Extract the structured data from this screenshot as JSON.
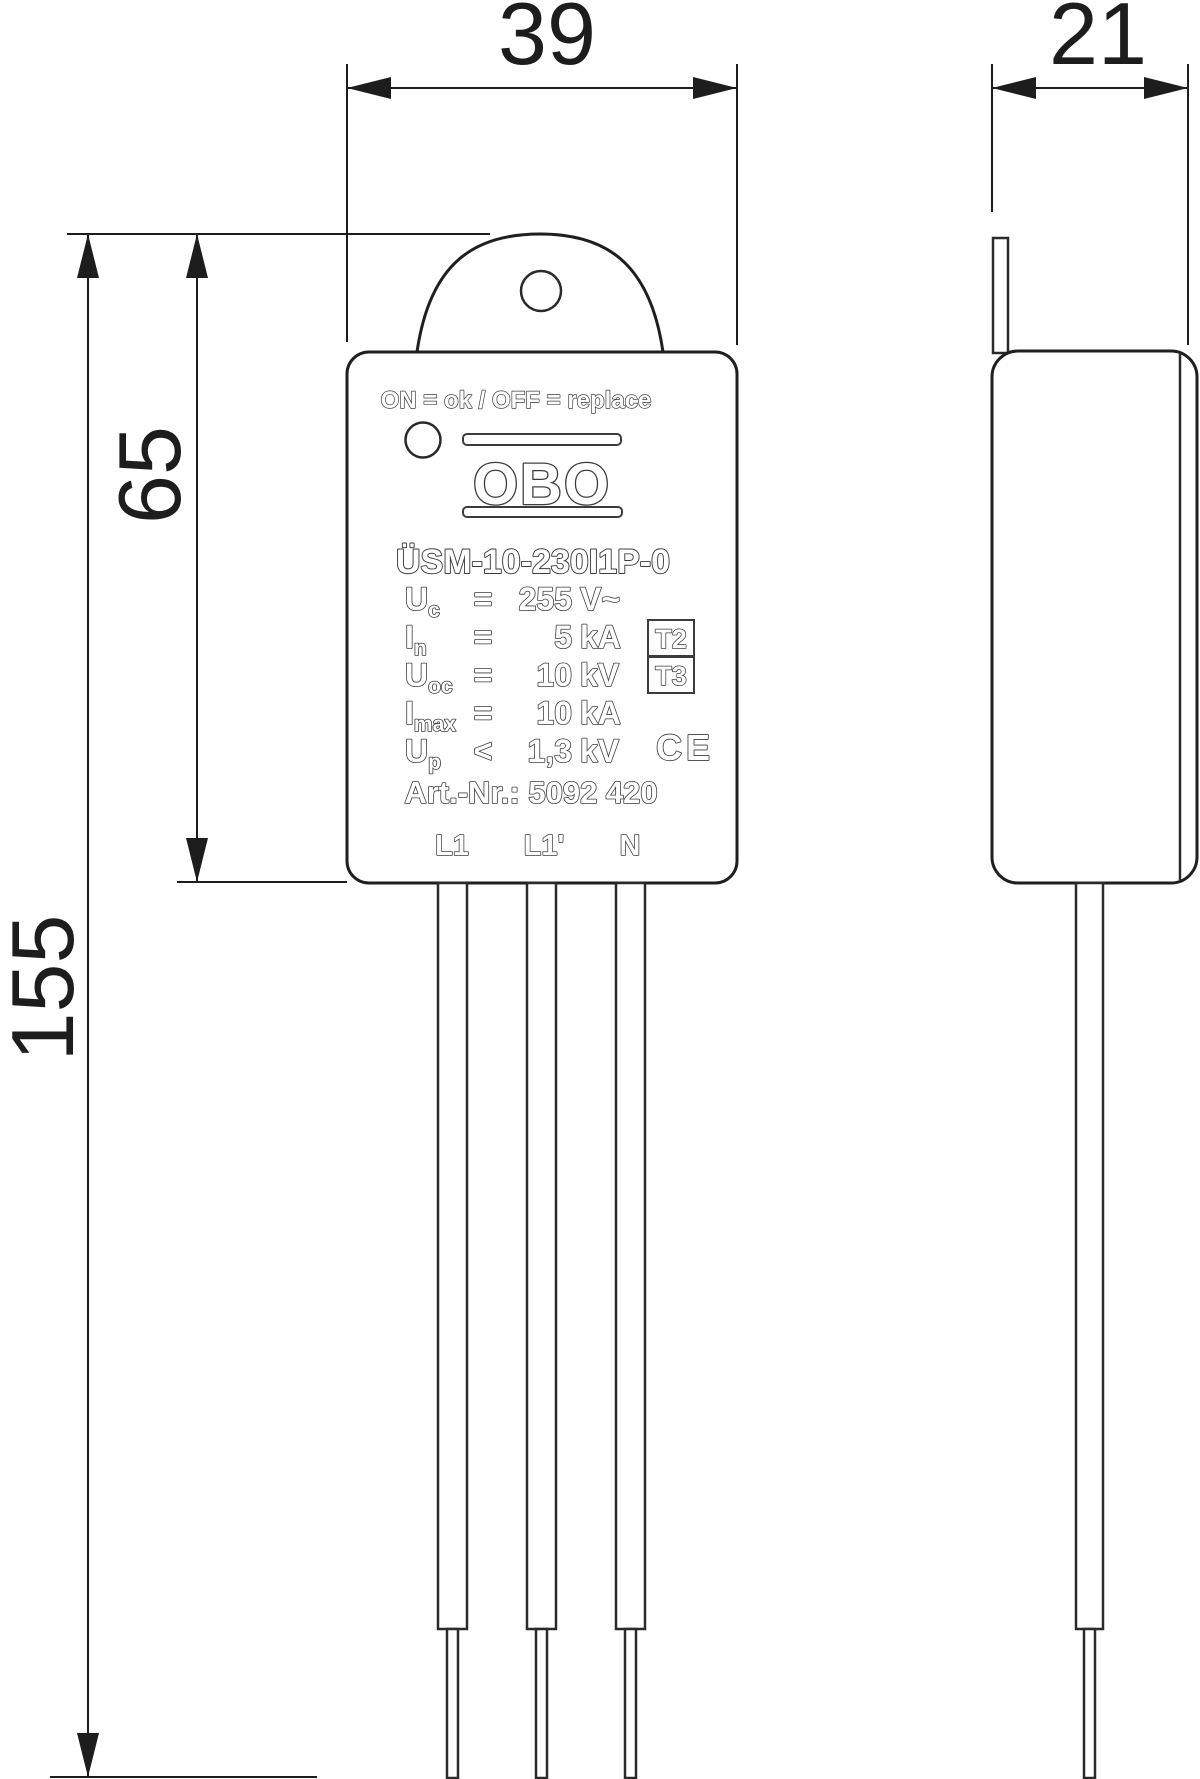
{
  "dimensions": {
    "front_width": "39",
    "side_depth": "21",
    "body_height": "65",
    "total_height": "155"
  },
  "device_label": {
    "status_line": "ON = ok  /  OFF = replace",
    "brand": "OBO",
    "model": "ÜSM-10-230I1P-0",
    "specs": [
      {
        "symbol": "U",
        "subscript": "c",
        "operator": "=",
        "value": "255",
        "unit": "V~"
      },
      {
        "symbol": "I",
        "subscript": "n",
        "operator": "=",
        "value": "5",
        "unit": "kA"
      },
      {
        "symbol": "U",
        "subscript": "oc",
        "operator": "=",
        "value": "10",
        "unit": "kV"
      },
      {
        "symbol": "I",
        "subscript": "max",
        "operator": "=",
        "value": "10",
        "unit": "kA"
      },
      {
        "symbol": "U",
        "subscript": "p",
        "operator": "<",
        "value": "1,3",
        "unit": "kV"
      }
    ],
    "type_badges": [
      "T2",
      "T3"
    ],
    "ce_mark": "CE",
    "article_number": "Art.-Nr.: 5092 420",
    "terminals": [
      "L1",
      "L1'",
      "N"
    ]
  },
  "colors": {
    "line": "#1d1d1d",
    "label_stroke": "#3c3c3c",
    "background": "#ffffff"
  }
}
